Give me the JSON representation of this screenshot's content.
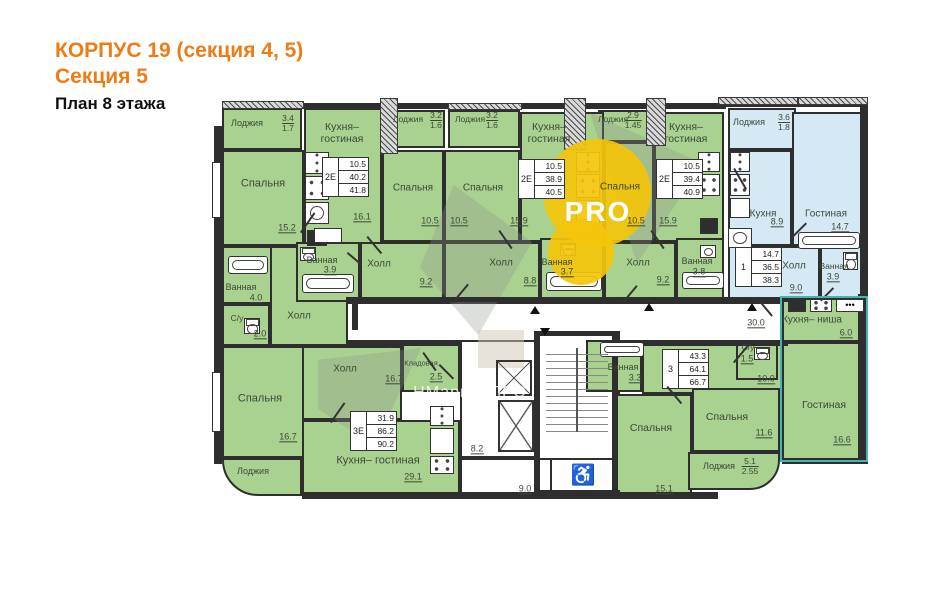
{
  "header": {
    "line1": "КОРПУС 19 (секция 4, 5)",
    "line2": "Секция 5",
    "line3": "План 8 этажа"
  },
  "colors": {
    "accent_orange": "#ee7c15",
    "room_green": "#a9d18f",
    "room_blue": "#d5e9f4",
    "wall": "#2e2e2e",
    "label": "#3c4837",
    "watermark_yellow": "#f4c40a",
    "studio_outline_teal": "#45b5ae"
  },
  "watermark": {
    "logo_text": "PRO",
    "site_text": "НМаркет.ПРО"
  },
  "plan": {
    "rooms": [
      [
        222,
        108,
        80,
        42,
        "g"
      ],
      [
        388,
        110,
        57,
        38,
        "g"
      ],
      [
        448,
        110,
        72,
        38,
        "g"
      ],
      [
        598,
        110,
        57,
        32,
        "g"
      ],
      [
        728,
        108,
        68,
        42,
        "b"
      ],
      [
        222,
        150,
        82,
        96,
        "g"
      ],
      [
        304,
        108,
        78,
        138,
        "g"
      ],
      [
        382,
        150,
        62,
        92,
        "g"
      ],
      [
        444,
        150,
        76,
        92,
        "g"
      ],
      [
        520,
        112,
        84,
        130,
        "g"
      ],
      [
        604,
        142,
        50,
        100,
        "g"
      ],
      [
        654,
        112,
        70,
        130,
        "g"
      ],
      [
        728,
        150,
        64,
        96,
        "b"
      ],
      [
        792,
        112,
        74,
        134,
        "b"
      ],
      [
        728,
        246,
        92,
        56,
        "b"
      ],
      [
        820,
        246,
        46,
        56,
        "b"
      ],
      [
        222,
        246,
        62,
        58,
        "g"
      ],
      [
        222,
        304,
        48,
        42,
        "g"
      ],
      [
        270,
        246,
        90,
        100,
        "g"
      ],
      [
        296,
        242,
        64,
        60,
        "g"
      ],
      [
        360,
        242,
        84,
        60,
        "g"
      ],
      [
        444,
        242,
        96,
        60,
        "g"
      ],
      [
        540,
        238,
        64,
        64,
        "g"
      ],
      [
        604,
        242,
        72,
        60,
        "g"
      ],
      [
        676,
        238,
        48,
        64,
        "g"
      ],
      [
        222,
        346,
        82,
        112,
        "g"
      ],
      [
        222,
        458,
        80,
        38,
        "g",
        "0 0 0 36px"
      ],
      [
        302,
        346,
        100,
        74,
        "g"
      ],
      [
        402,
        340,
        58,
        52,
        "g"
      ],
      [
        302,
        420,
        158,
        76,
        "g"
      ],
      [
        346,
        302,
        444,
        40,
        "w"
      ],
      [
        460,
        340,
        78,
        118,
        "w"
      ],
      [
        538,
        333,
        82,
        162,
        "w"
      ],
      [
        460,
        458,
        158,
        38,
        "w"
      ],
      [
        550,
        458,
        64,
        36,
        "w"
      ],
      [
        586,
        340,
        56,
        52,
        "g"
      ],
      [
        642,
        340,
        148,
        54,
        "g"
      ],
      [
        736,
        340,
        42,
        40,
        "g"
      ],
      [
        616,
        394,
        76,
        102,
        "g"
      ],
      [
        692,
        388,
        88,
        64,
        "g"
      ],
      [
        688,
        452,
        92,
        38,
        "g",
        "0 0 30px 0"
      ],
      [
        782,
        298,
        84,
        44,
        "g"
      ],
      [
        782,
        342,
        84,
        118,
        "g"
      ]
    ],
    "walls": [
      [
        214,
        126,
        8,
        338,
        0
      ],
      [
        302,
        103,
        424,
        6,
        0
      ],
      [
        724,
        101,
        144,
        6,
        0
      ],
      [
        860,
        101,
        8,
        200,
        0
      ],
      [
        858,
        294,
        9,
        170,
        0
      ],
      [
        302,
        492,
        416,
        7,
        0
      ],
      [
        782,
        458,
        86,
        6,
        0
      ],
      [
        346,
        297,
        444,
        5,
        0
      ],
      [
        346,
        341,
        116,
        5,
        0
      ],
      [
        616,
        341,
        172,
        5,
        0
      ],
      [
        536,
        331,
        84,
        5,
        0
      ],
      [
        534,
        331,
        6,
        164,
        0
      ],
      [
        612,
        331,
        6,
        164,
        0
      ],
      [
        536,
        490,
        84,
        6,
        0
      ],
      [
        352,
        304,
        6,
        26,
        0
      ],
      [
        380,
        98,
        16,
        54,
        1
      ],
      [
        564,
        98,
        20,
        50,
        1
      ],
      [
        646,
        98,
        18,
        46,
        1
      ],
      [
        222,
        101,
        80,
        6,
        1
      ],
      [
        448,
        103,
        72,
        5,
        1
      ],
      [
        718,
        97,
        78,
        6,
        1
      ],
      [
        798,
        97,
        68,
        6,
        1
      ]
    ],
    "labels": [
      [
        "Лоджия",
        247,
        123,
        9,
        ""
      ],
      [
        "Спальня",
        263,
        184,
        11,
        ""
      ],
      [
        "15.2",
        287,
        228,
        9,
        "u"
      ],
      [
        "Кухня–\nгостиная",
        342,
        133,
        10.5,
        ""
      ],
      [
        "16.1",
        362,
        217,
        9,
        "u"
      ],
      [
        "Лоджия",
        408,
        120,
        8.5,
        ""
      ],
      [
        "Лоджия",
        470,
        120,
        8.5,
        ""
      ],
      [
        "Спальня",
        413,
        188,
        10,
        ""
      ],
      [
        "10.5",
        430,
        221,
        9,
        "u"
      ],
      [
        "Спальня",
        483,
        188,
        10,
        ""
      ],
      [
        "10.5",
        459,
        221,
        9,
        "u"
      ],
      [
        "Кухня–\nгостиная",
        549,
        133,
        10.5,
        ""
      ],
      [
        "15.9",
        519,
        221,
        9,
        "u"
      ],
      [
        "Лоджия",
        613,
        120,
        8.5,
        ""
      ],
      [
        "Спальня",
        620,
        187,
        10,
        ""
      ],
      [
        "10.5",
        636,
        221,
        9,
        "u"
      ],
      [
        "Кухня–\nгостиная",
        686,
        133,
        10.5,
        ""
      ],
      [
        "15.9",
        668,
        221,
        9,
        "u"
      ],
      [
        "Лоджия",
        749,
        122,
        9,
        ""
      ],
      [
        "Кухня",
        763,
        214,
        10,
        ""
      ],
      [
        "8.9",
        777,
        222,
        9,
        "u"
      ],
      [
        "Гостиная",
        826,
        214,
        10,
        ""
      ],
      [
        "14.7",
        840,
        227,
        9,
        "u"
      ],
      [
        "Ванная",
        241,
        287,
        9,
        ""
      ],
      [
        "4.0",
        256,
        298,
        9,
        "u"
      ],
      [
        "С/у",
        237,
        319,
        8.5,
        ""
      ],
      [
        "2.0",
        260,
        334,
        9,
        "u"
      ],
      [
        "Холл",
        299,
        316,
        10,
        ""
      ],
      [
        "Ванная",
        322,
        260,
        9,
        ""
      ],
      [
        "3.9",
        330,
        270,
        9,
        "u"
      ],
      [
        "Холл",
        379,
        264,
        10,
        ""
      ],
      [
        "9.2",
        426,
        282,
        9,
        "u"
      ],
      [
        "Холл",
        501,
        263,
        10,
        ""
      ],
      [
        "8.8",
        530,
        281,
        9,
        "u"
      ],
      [
        "Ванная",
        557,
        262,
        9,
        ""
      ],
      [
        "3.7",
        567,
        272,
        9,
        "u"
      ],
      [
        "Холл",
        638,
        263,
        10,
        ""
      ],
      [
        "9.2",
        663,
        280,
        9,
        "u"
      ],
      [
        "Ванная",
        697,
        261,
        9,
        ""
      ],
      [
        "3.8",
        699,
        272,
        9,
        "u"
      ],
      [
        "Холл",
        794,
        266,
        10,
        ""
      ],
      [
        "9.0",
        796,
        288,
        9,
        "u"
      ],
      [
        "Ванная",
        834,
        267,
        8.5,
        ""
      ],
      [
        "3.9",
        833,
        277,
        9,
        "u"
      ],
      [
        "30.0",
        756,
        323,
        9,
        "u"
      ],
      [
        "Спальня",
        260,
        399,
        11,
        ""
      ],
      [
        "16.7",
        288,
        437,
        9,
        "u"
      ],
      [
        "Холл",
        345,
        369,
        10,
        ""
      ],
      [
        "16.7",
        394,
        379,
        9,
        "u"
      ],
      [
        "Кладовая",
        421,
        364,
        7.5,
        ""
      ],
      [
        "2.5",
        436,
        377,
        9,
        "u"
      ],
      [
        "Кухня– гостиная",
        378,
        461,
        11,
        ""
      ],
      [
        "29.1",
        413,
        477,
        9,
        "u"
      ],
      [
        "Лоджия",
        253,
        471,
        9,
        ""
      ],
      [
        "8.2",
        477,
        449,
        9,
        "u"
      ],
      [
        "9.0",
        525,
        489,
        9,
        "u"
      ],
      [
        "Ванная",
        623,
        367,
        9,
        ""
      ],
      [
        "3.3",
        635,
        378,
        9,
        "u"
      ],
      [
        "С/у",
        748,
        348,
        8.5,
        ""
      ],
      [
        "1.5",
        747,
        359,
        9,
        "u"
      ],
      [
        "10.0",
        766,
        379,
        9,
        "u"
      ],
      [
        "Спальня",
        651,
        428,
        10.5,
        ""
      ],
      [
        "15.1",
        664,
        489,
        9,
        "u"
      ],
      [
        "Спальня",
        727,
        417,
        10.5,
        ""
      ],
      [
        "11.6",
        764,
        433,
        9,
        "u"
      ],
      [
        "Лоджия",
        719,
        466,
        9,
        ""
      ],
      [
        "Кухня– ниша",
        812,
        320,
        10,
        ""
      ],
      [
        "6.0",
        846,
        333,
        9,
        "u"
      ],
      [
        "Гостиная",
        824,
        405,
        10.5,
        ""
      ],
      [
        "16.6",
        842,
        440,
        9,
        "u"
      ],
      [
        "♿",
        583,
        476,
        20,
        "k"
      ]
    ],
    "fractions": [
      [
        288,
        114,
        "3.4",
        "1.7"
      ],
      [
        436,
        111,
        "3.2",
        "1.6"
      ],
      [
        492,
        111,
        "3.2",
        "1.6"
      ],
      [
        633,
        111,
        "2.9",
        "1.45"
      ],
      [
        784,
        113,
        "3.6",
        "1.8"
      ],
      [
        750,
        457,
        "5.1",
        "2.55"
      ]
    ],
    "stamps": [
      [
        322,
        157,
        "2Е",
        [
          "10.5",
          "40.2",
          "41.8"
        ]
      ],
      [
        518,
        159,
        "2Е",
        [
          "10.5",
          "38.9",
          "40.5"
        ]
      ],
      [
        656,
        159,
        "2Е",
        [
          "10.5",
          "39.4",
          "40.9"
        ]
      ],
      [
        735,
        247,
        "1",
        [
          "14.7",
          "36.5",
          "38.3"
        ]
      ],
      [
        662,
        349,
        "3",
        [
          "43.3",
          "64.1",
          "66.7"
        ]
      ],
      [
        350,
        411,
        "3Е",
        [
          "31.9",
          "86.2",
          "90.2"
        ]
      ]
    ],
    "fixtures": [
      [
        "fridge",
        305,
        152,
        24,
        22
      ],
      [
        "stove",
        305,
        176,
        24,
        24
      ],
      [
        "sink",
        305,
        202,
        24,
        22
      ],
      [
        "black",
        307,
        230,
        20,
        16
      ],
      [
        "counter",
        314,
        228,
        28,
        15
      ],
      [
        "fridge",
        576,
        152,
        24,
        20
      ],
      [
        "stove",
        576,
        174,
        24,
        24
      ],
      [
        "counter",
        576,
        200,
        24,
        26
      ],
      [
        "fridge",
        698,
        152,
        22,
        20
      ],
      [
        "stove",
        698,
        174,
        22,
        22
      ],
      [
        "black",
        700,
        218,
        18,
        16
      ],
      [
        "fridge",
        730,
        152,
        20,
        20
      ],
      [
        "stove",
        730,
        174,
        20,
        22
      ],
      [
        "counter",
        730,
        198,
        20,
        20
      ],
      [
        "sink",
        728,
        228,
        24,
        20
      ],
      [
        "tub",
        798,
        232,
        62,
        17
      ],
      [
        "wc",
        843,
        252,
        15,
        18
      ],
      [
        "tub",
        228,
        256,
        40,
        18
      ],
      [
        "wc",
        244,
        318,
        16,
        16
      ],
      [
        "wc",
        300,
        247,
        16,
        14
      ],
      [
        "tub",
        302,
        274,
        52,
        19
      ],
      [
        "wc",
        560,
        243,
        16,
        13
      ],
      [
        "tub",
        546,
        272,
        56,
        19
      ],
      [
        "tub",
        682,
        272,
        42,
        17
      ],
      [
        "sink",
        700,
        245,
        16,
        13
      ],
      [
        "tub",
        600,
        342,
        44,
        15
      ],
      [
        "wc",
        754,
        347,
        16,
        13
      ],
      [
        "fridge",
        430,
        406,
        24,
        20
      ],
      [
        "counter",
        430,
        428,
        24,
        26
      ],
      [
        "stove",
        430,
        456,
        24,
        18
      ],
      [
        "black",
        788,
        299,
        18,
        13
      ],
      [
        "stove",
        810,
        299,
        22,
        13
      ],
      [
        "dots",
        836,
        299,
        28,
        13
      ],
      [
        "elev",
        496,
        360,
        36,
        36
      ],
      [
        "elev",
        498,
        400,
        36,
        52
      ],
      [
        "stairs",
        546,
        348,
        62,
        84
      ]
    ],
    "doors": [
      [
        300,
        232,
        24,
        -55
      ],
      [
        368,
        236,
        22,
        50
      ],
      [
        452,
        302,
        24,
        -50
      ],
      [
        500,
        230,
        22,
        55
      ],
      [
        622,
        302,
        22,
        -50
      ],
      [
        652,
        230,
        22,
        55
      ],
      [
        735,
        168,
        24,
        60
      ],
      [
        790,
        238,
        22,
        -45
      ],
      [
        668,
        386,
        22,
        50
      ],
      [
        733,
        362,
        22,
        -50
      ],
      [
        424,
        352,
        22,
        55
      ],
      [
        330,
        422,
        24,
        -55
      ],
      [
        440,
        364,
        20,
        45
      ],
      [
        760,
        300,
        20,
        50
      ],
      [
        820,
        300,
        18,
        -45
      ],
      [
        348,
        252,
        18,
        40
      ]
    ],
    "tris": [
      [
        530,
        306,
        0
      ],
      [
        540,
        328,
        180
      ],
      [
        644,
        303,
        0
      ],
      [
        747,
        303,
        0
      ]
    ],
    "polys": [
      [
        420,
        185,
        112,
        150,
        "30% 0,100% 38%,52% 100%,0 55%"
      ],
      [
        318,
        348,
        112,
        98,
        "0 12%,92% 0,50% 100%,0 62%"
      ],
      [
        590,
        96,
        112,
        168,
        "0 10%,100% 40%,42% 100%"
      ]
    ],
    "beige": [
      478,
      330,
      46,
      38
    ],
    "ycircles": [
      [
        597,
        193,
        54
      ],
      [
        581,
        252,
        33
      ]
    ],
    "pro_pos": [
      598,
      212
    ],
    "site_pos": [
      470,
      393
    ],
    "teal_outline": [
      780,
      296,
      88,
      166
    ],
    "windows": [
      [
        212,
        162,
        9,
        56
      ],
      [
        212,
        372,
        9,
        60
      ]
    ]
  }
}
